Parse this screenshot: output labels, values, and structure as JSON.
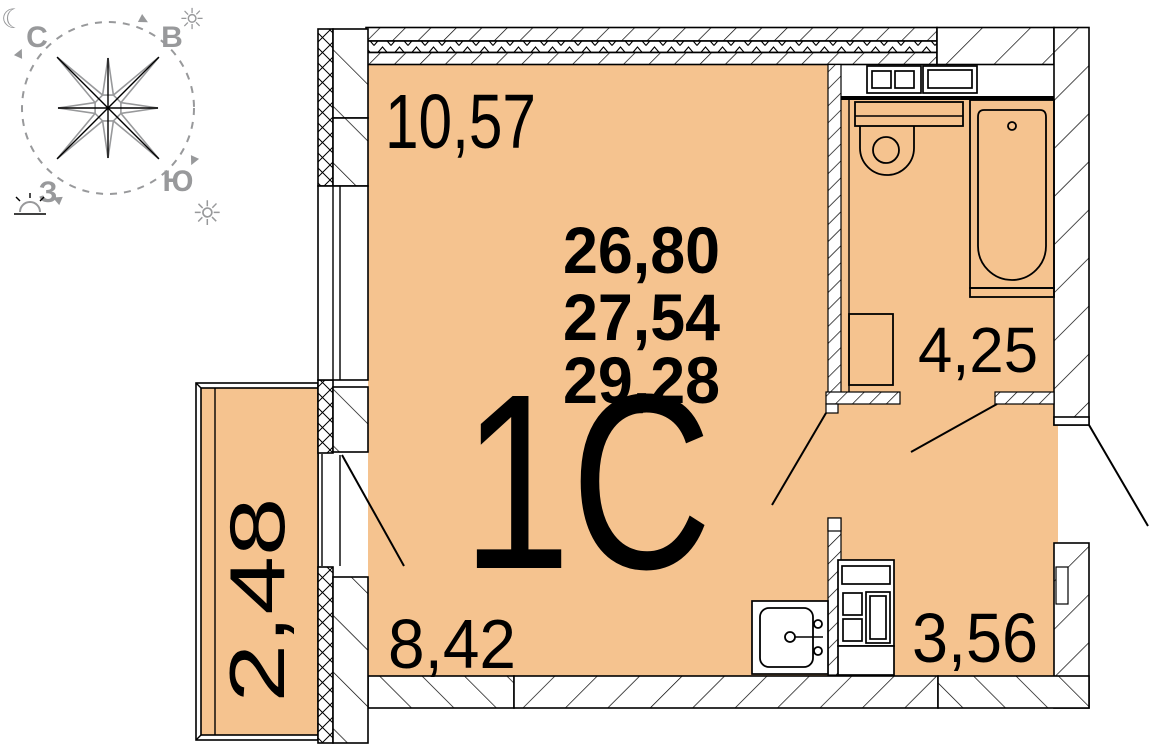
{
  "page": {
    "background": "#ffffff"
  },
  "unit": {
    "type_label": "1С"
  },
  "area_summary": {
    "line1": "26,80",
    "line2": "27,54",
    "line3": "29,28"
  },
  "rooms": {
    "living_area": "10,57",
    "kitchen_area": "8,42",
    "bathroom_area": "4,25",
    "hallway_area": "3,56",
    "balcony_area": "2,48"
  },
  "compass": {
    "north": "С",
    "east": "В",
    "west": "З",
    "south": "Ю",
    "moon_icon": "☾",
    "sun_icon": "☼"
  },
  "colors": {
    "floor": "#F5C38F",
    "lines": "#000000",
    "compass": "#98999B"
  }
}
